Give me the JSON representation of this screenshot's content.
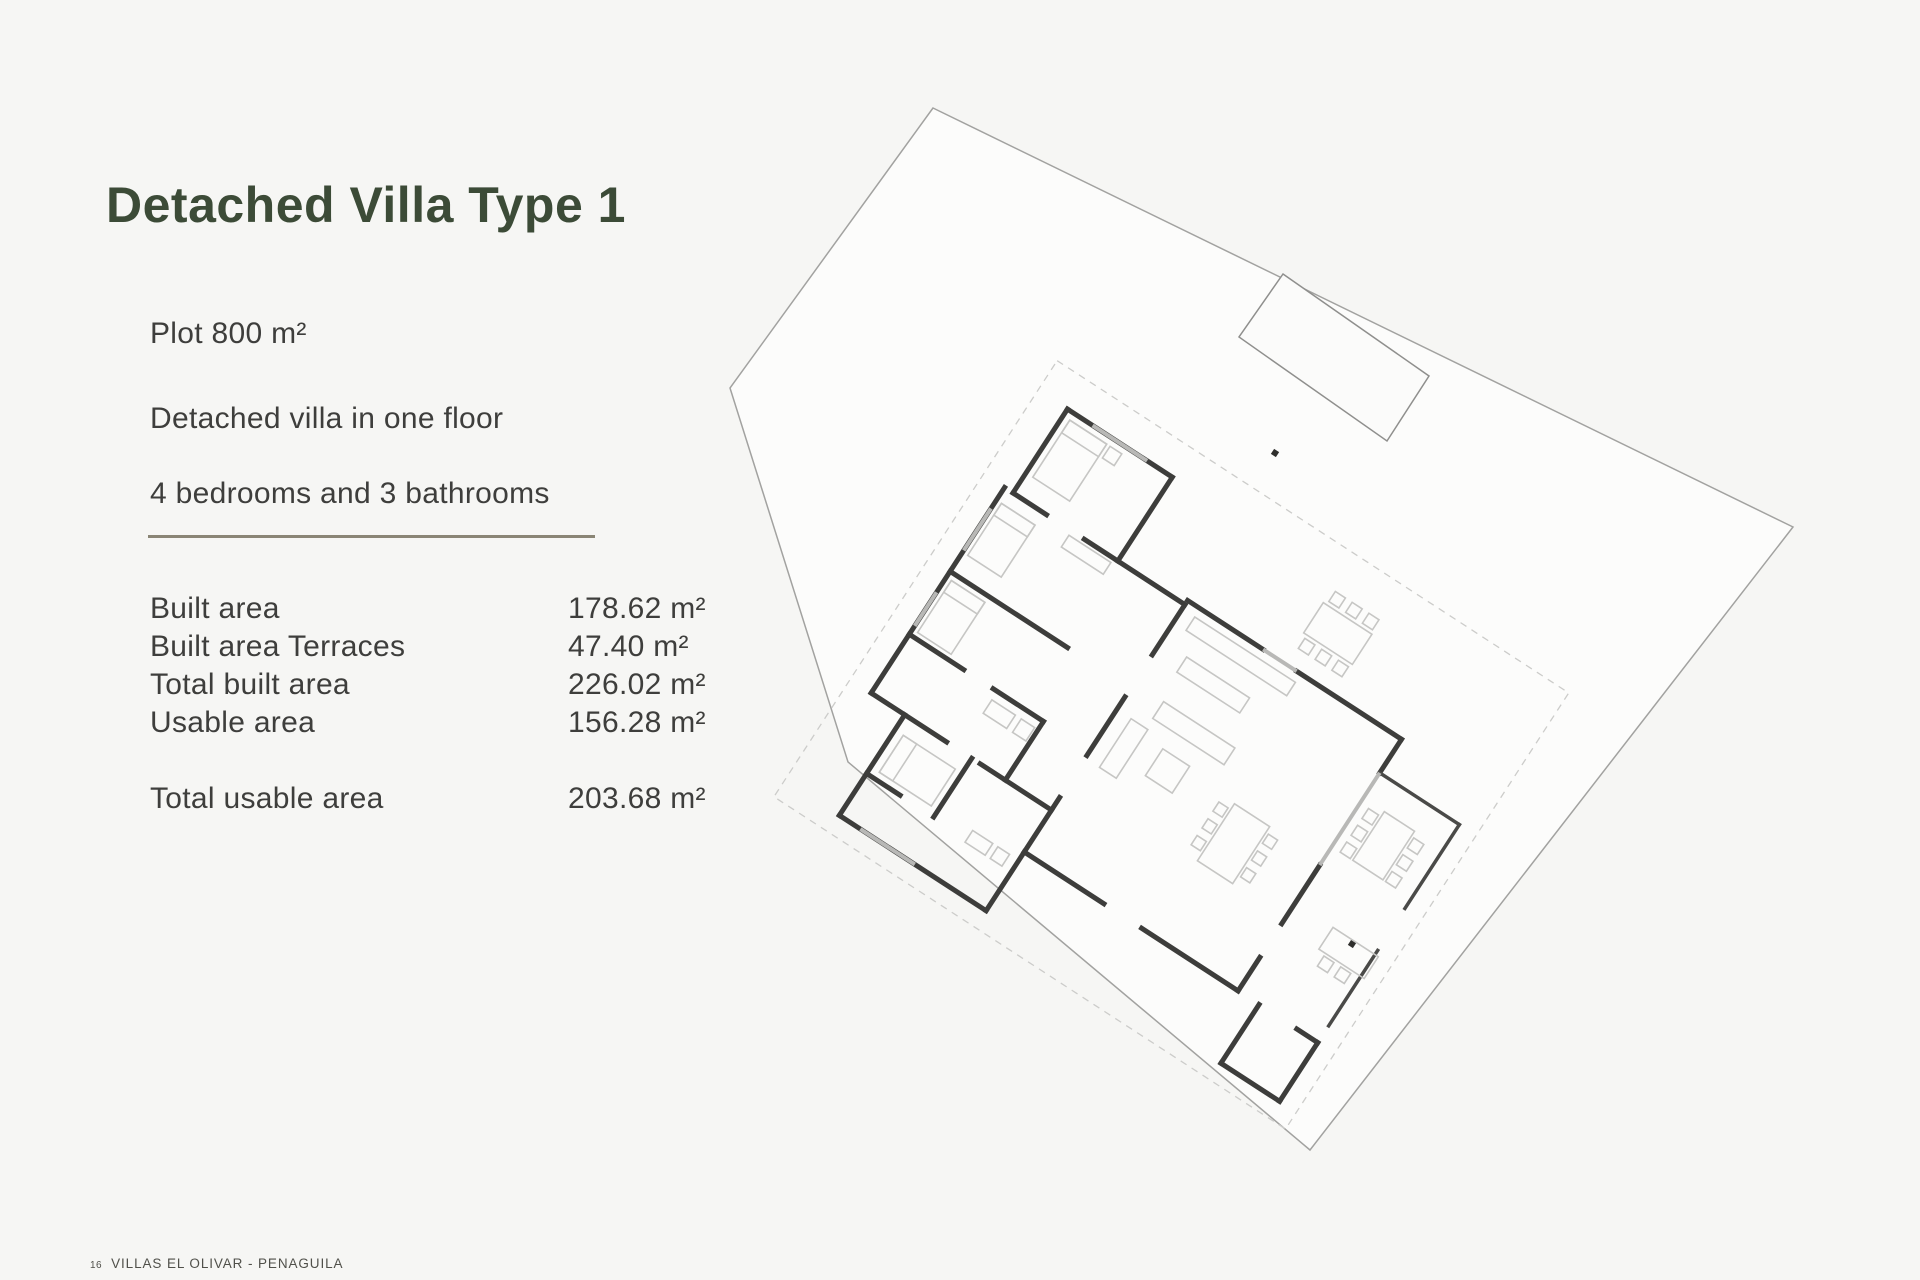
{
  "page": {
    "title": "Detached Villa Type 1",
    "background_color": "#f6f6f4",
    "title_color": "#3c4b37",
    "text_color": "#3e3e3c",
    "divider_color": "#8a8575"
  },
  "description": {
    "line1": "Plot 800 m²",
    "line2": "Detached villa in one floor",
    "line3": "4 bedrooms and 3 bathrooms"
  },
  "specs": {
    "rows": [
      {
        "label": "Built area",
        "value": "178.62 m²"
      },
      {
        "label": "Built area Terraces",
        "value": "47.40 m²"
      },
      {
        "label": "Total built area",
        "value": "226.02 m²"
      },
      {
        "label": "Usable area",
        "value": "156.28 m²"
      }
    ],
    "total_row": {
      "label": "Total usable area",
      "value": "203.68 m²"
    }
  },
  "footer": {
    "page_number": "16",
    "project_name": "VILLAS EL OLIVAR - PENAGUILA"
  },
  "floor_plan": {
    "type": "site-plan",
    "elements": [
      "plot-boundary",
      "swimming-pool",
      "villa-floor-plan",
      "terrace-parapet",
      "porch",
      "outdoor-dining-furniture",
      "survey-markers"
    ],
    "wall_color": "#3d3d3b",
    "plot_line_color": "#a2a2a0",
    "furniture_color": "#c6c6c4"
  }
}
